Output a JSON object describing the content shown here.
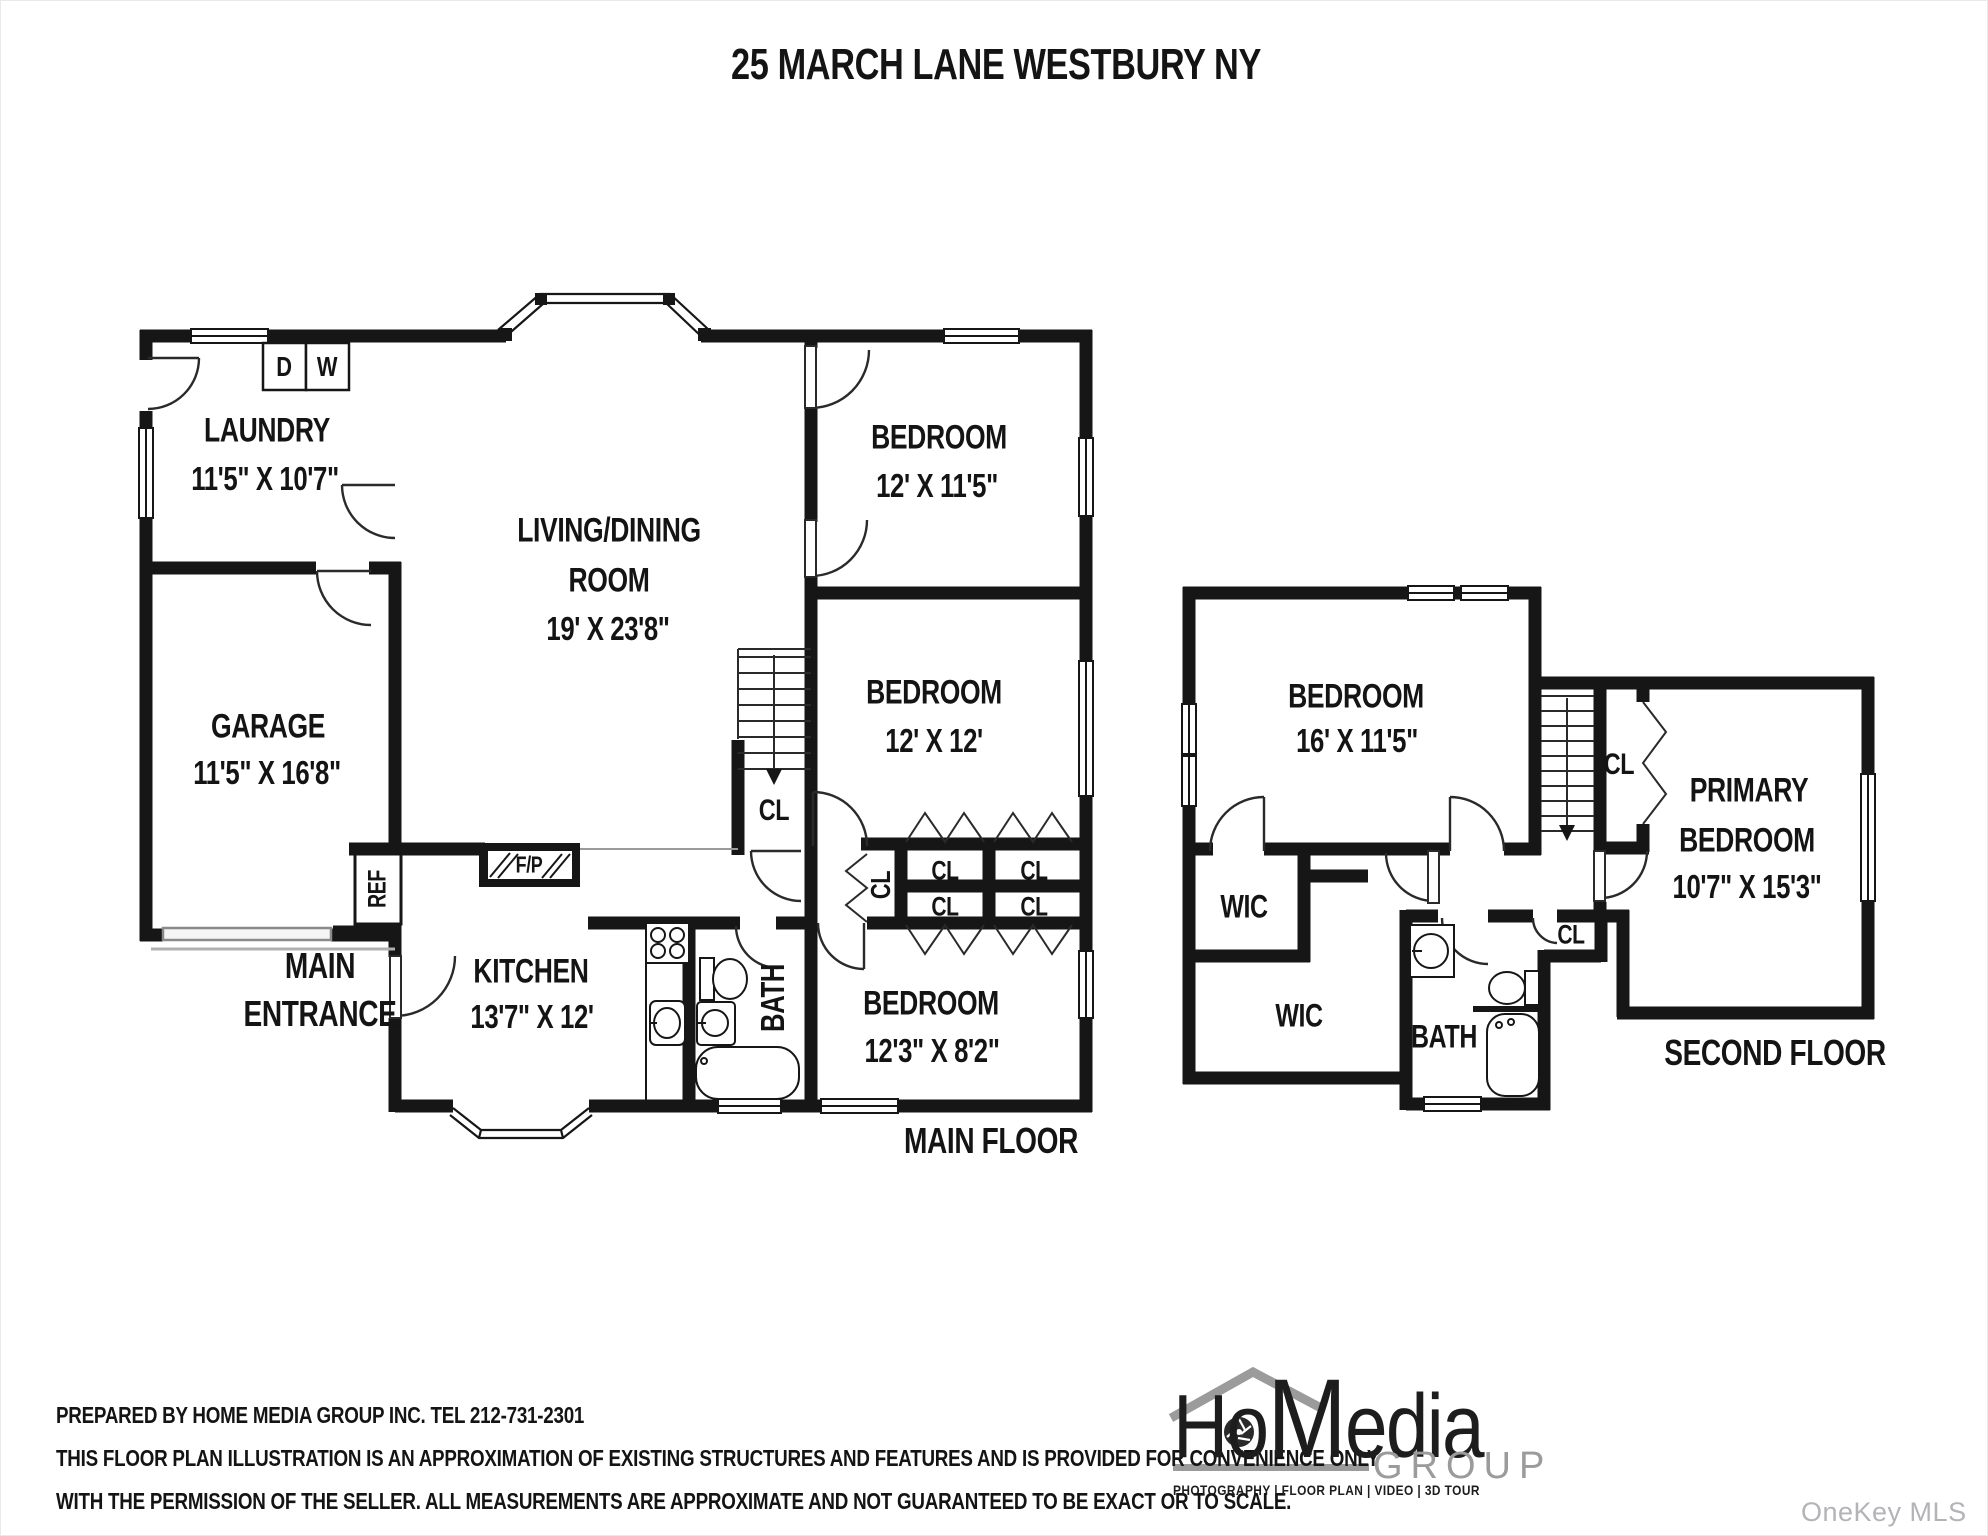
{
  "page": {
    "title": "25 MARCH LANE WESTBURY NY",
    "watermark": "OneKey MLS"
  },
  "main_floor": {
    "floor_label": "MAIN FLOOR",
    "entrance_line1": "MAIN",
    "entrance_line2": "ENTRANCE",
    "laundry_name": "LAUNDRY",
    "laundry_dims": "11'5\" X 10'7\"",
    "garage_name": "GARAGE",
    "garage_dims": "11'5\" X 16'8\"",
    "living_name1": "LIVING/DINING",
    "living_name2": "ROOM",
    "living_dims": "19' X 23'8\"",
    "bedroom1_name": "BEDROOM",
    "bedroom1_dims": "12' X 11'5\"",
    "bedroom2_name": "BEDROOM",
    "bedroom2_dims": "12' X 12'",
    "bedroom3_name": "BEDROOM",
    "bedroom3_dims": "12'3\" X 8'2\"",
    "kitchen_name": "KITCHEN",
    "kitchen_dims": "13'7\" X 12'",
    "bath_label": "BATH",
    "closet_label": "CL",
    "dryer_label": "D",
    "washer_label": "W",
    "fridge_label": "REF",
    "fireplace_label": "F/P"
  },
  "second_floor": {
    "floor_label": "SECOND FLOOR",
    "bedroom_name": "BEDROOM",
    "bedroom_dims": "16' X 11'5\"",
    "primary_name1": "PRIMARY",
    "primary_name2": "BEDROOM",
    "primary_dims": "10'7\" X 15'3\"",
    "wic_label": "WIC",
    "bath_label": "BATH",
    "closet_label": "CL"
  },
  "footer": {
    "line1": "PREPARED BY  HOME MEDIA GROUP INC.  TEL 212-731-2301",
    "line2": "THIS FLOOR PLAN ILLUSTRATION IS AN APPROXIMATION OF EXISTING STRUCTURES AND FEATURES AND IS PROVIDED FOR CONVENIENCE ONLY",
    "line3": "WITH THE PERMISSION OF THE SELLER. ALL MEASUREMENTS ARE APPROXIMATE AND NOT GUARANTEED TO BE EXACT OR TO SCALE."
  },
  "logo": {
    "word_part1": "Ho",
    "word_part2": "M",
    "word_part3": "edia",
    "group": "GROUP",
    "tagline": "PHOTOGRAPHY | FLOOR PLAN | VIDEO | 3D TOUR"
  }
}
